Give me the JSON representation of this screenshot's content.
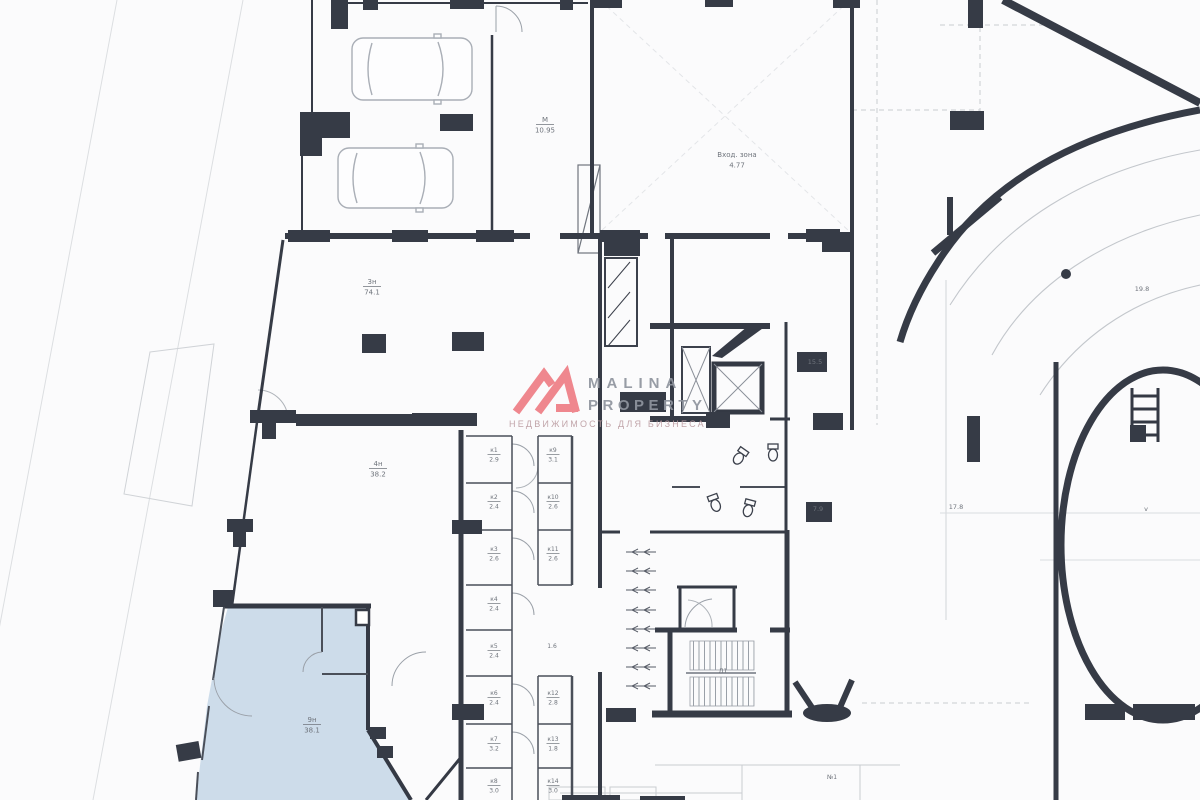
{
  "watermark": {
    "line1": "MALINA",
    "line2": "PROPERTY",
    "line3": "НЕДВИЖИМОСТЬ ДЛЯ БИЗНЕСА",
    "logo_color": "#ee7e85",
    "text_color": "#8f949e",
    "subtext_color": "#bc9da2"
  },
  "colors": {
    "wall": "#363b46",
    "medium_wall": "#7d828b",
    "fixture": "#b0b5bc",
    "faint": "#d5d8dc",
    "highlight_fill": "#cddcea",
    "label": "#6f747c"
  },
  "plan": {
    "highlight_room": {
      "id": "9н",
      "area": "38.1",
      "fill": "#cddcea"
    },
    "labels": [
      {
        "x": 545,
        "y": 122,
        "lines": [
          "М",
          "10.95"
        ],
        "rule": true,
        "s": 7
      },
      {
        "x": 737,
        "y": 157,
        "lines": [
          "Вход. зона",
          "4.77"
        ],
        "rule": false,
        "s": 7
      },
      {
        "x": 372,
        "y": 284,
        "lines": [
          "3н",
          "74.1"
        ],
        "rule": true,
        "s": 7
      },
      {
        "x": 378,
        "y": 466,
        "lines": [
          "4н",
          "38.2"
        ],
        "rule": true,
        "s": 7
      },
      {
        "x": 312,
        "y": 722,
        "lines": [
          "9н",
          "38.1"
        ],
        "rule": true,
        "s": 7
      },
      {
        "x": 815,
        "y": 364,
        "lines": [
          "15.5"
        ],
        "rule": false,
        "s": 6.5
      },
      {
        "x": 818,
        "y": 511,
        "lines": [
          "7.9"
        ],
        "rule": false,
        "s": 6.5
      },
      {
        "x": 956,
        "y": 509,
        "lines": [
          "17.8"
        ],
        "rule": false,
        "s": 6.5
      },
      {
        "x": 1142,
        "y": 291,
        "lines": [
          "19.8"
        ],
        "rule": false,
        "s": 6.5
      },
      {
        "x": 1146,
        "y": 511,
        "lines": [
          "v"
        ],
        "rule": false,
        "s": 6.5
      },
      {
        "x": 723,
        "y": 673,
        "lines": [
          "Л1"
        ],
        "rule": false,
        "s": 6.5
      },
      {
        "x": 832,
        "y": 779,
        "lines": [
          "№1"
        ],
        "rule": false,
        "s": 6
      },
      {
        "x": 552,
        "y": 648,
        "lines": [
          "1.6"
        ],
        "rule": false,
        "s": 6
      },
      {
        "x": 494,
        "y": 452,
        "lines": [
          "к1",
          "2.9"
        ],
        "rule": true,
        "s": 6
      },
      {
        "x": 494,
        "y": 499,
        "lines": [
          "к2",
          "2.4"
        ],
        "rule": true,
        "s": 6
      },
      {
        "x": 494,
        "y": 551,
        "lines": [
          "к3",
          "2.6"
        ],
        "rule": true,
        "s": 6
      },
      {
        "x": 494,
        "y": 601,
        "lines": [
          "к4",
          "2.4"
        ],
        "rule": true,
        "s": 6
      },
      {
        "x": 494,
        "y": 648,
        "lines": [
          "к5",
          "2.4"
        ],
        "rule": true,
        "s": 6
      },
      {
        "x": 494,
        "y": 695,
        "lines": [
          "к6",
          "2.4"
        ],
        "rule": true,
        "s": 6
      },
      {
        "x": 494,
        "y": 741,
        "lines": [
          "к7",
          "3.2"
        ],
        "rule": true,
        "s": 6
      },
      {
        "x": 494,
        "y": 783,
        "lines": [
          "к8",
          "3.0"
        ],
        "rule": true,
        "s": 6
      },
      {
        "x": 553,
        "y": 452,
        "lines": [
          "к9",
          "3.1"
        ],
        "rule": true,
        "s": 6
      },
      {
        "x": 553,
        "y": 499,
        "lines": [
          "к10",
          "2.6"
        ],
        "rule": true,
        "s": 6
      },
      {
        "x": 553,
        "y": 551,
        "lines": [
          "к11",
          "2.6"
        ],
        "rule": true,
        "s": 6
      },
      {
        "x": 553,
        "y": 695,
        "lines": [
          "к12",
          "2.8"
        ],
        "rule": true,
        "s": 6
      },
      {
        "x": 553,
        "y": 741,
        "lines": [
          "к13",
          "1.8"
        ],
        "rule": true,
        "s": 6
      },
      {
        "x": 553,
        "y": 783,
        "lines": [
          "к14",
          "3.0"
        ],
        "rule": true,
        "s": 6
      }
    ]
  }
}
